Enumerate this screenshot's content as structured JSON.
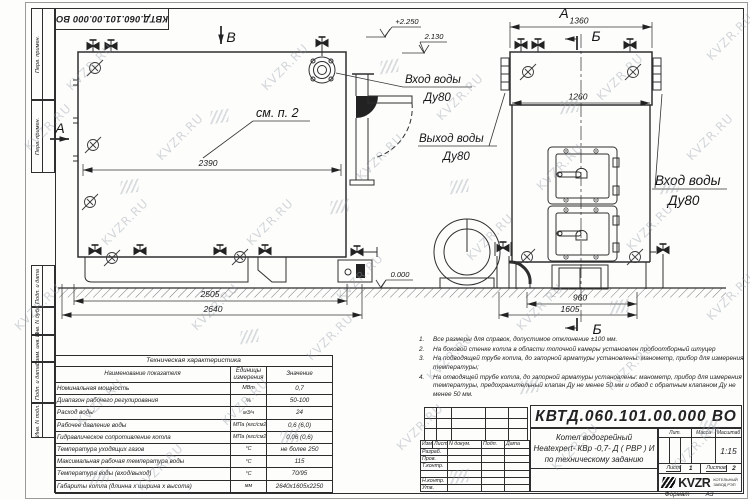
{
  "watermark": {
    "text": "KVZR.RU"
  },
  "margin": {
    "cells": [
      "Перв. примен.",
      "Перв. примен.",
      "Подп. и дата",
      "Инв. N дубл.",
      "Взам. инв. N",
      "Подп. и дата",
      "Инв. N подл."
    ]
  },
  "labels": {
    "view_b": "В",
    "view_a": "А",
    "section_b": "Б",
    "see_note": "см. п. 2",
    "water_in": "Вход воды",
    "water_out": "Выход воды",
    "dn": "Ду80",
    "elev_top": "+2.250",
    "elev_mid": "2.130",
    "elev_zero": "0.000"
  },
  "dims": {
    "side_inner": "2390",
    "side_base": "2505",
    "side_overall": "2640",
    "front_top": "1360",
    "front_inner": "1260",
    "front_base_inner": "960",
    "front_base": "1605"
  },
  "notes": [
    {
      "num": "1.",
      "text": "Все размеры для справок, допустимое отклонение ±100 мм."
    },
    {
      "num": "2.",
      "text": "На боковой стенке котла в области топочной камеры установлен пробоотборный штуцер"
    },
    {
      "num": "3.",
      "text": "На подводящей трубе котла, до запорной арматуры установлены: манометр, прибор для измерения температуры;"
    },
    {
      "num": "4.",
      "text": "На отводящей трубе котла, до запорной арматуры установлены: манометр, прибор для измерения температуры, предохранительный клапан Ду не менее 50 мм и обвод с обратным клапаном Ду не менее 50 мм."
    }
  ],
  "spec_table": {
    "title": "Техническая характеристика",
    "headers": [
      "Наименование показателя",
      "Единицы измерения",
      "Значение"
    ],
    "rows": [
      {
        "name": "Номинальная мощность",
        "unit": "МВт",
        "value": "0,7"
      },
      {
        "name": "Диапазон рабочего регулирования",
        "unit": "%",
        "value": "50-100"
      },
      {
        "name": "Расход воды",
        "unit": "м3/ч",
        "value": "24"
      },
      {
        "name": "Рабочее давление воды",
        "unit": "МПа (кгс/см2)",
        "value": "0,6 (6,0)"
      },
      {
        "name": "Гидравлическое сопротивление котла",
        "unit": "МПа (кгс/см2)",
        "value": "0,06 (0,6)"
      },
      {
        "name": "Температура уходящих газов",
        "unit": "°С",
        "value": "не более 250"
      },
      {
        "name": "Максимальная рабочая температура воды",
        "unit": "°С",
        "value": "115"
      },
      {
        "name": "Температура воды (вход/выход)",
        "unit": "°С",
        "value": "70/95"
      },
      {
        "name": "Габариты котла (длинна х ширина х высота)",
        "unit": "мм",
        "value": "2640х1605х2250"
      }
    ]
  },
  "title_block": {
    "doc_number": "КВТД.060.101.00.000 ВО",
    "header_cols": [
      "Изм.",
      "Лист",
      "N докум.",
      "Подп.",
      "Дата"
    ],
    "sign_rows": [
      "Разраб.",
      "Пров.",
      "Т.контр.",
      "",
      "Н.контр.",
      "Утв."
    ],
    "title_lines": [
      "Котел водогрейный",
      "Heatexpert- КВр -0,7- Д ( РВР ) И",
      "по техническому заданию"
    ],
    "lit_label": "Лит.",
    "mass_label": "Масса",
    "scale_label": "Масштаб",
    "scale_value": "1:15",
    "sheet_label": "Лист",
    "sheet_value": "1",
    "sheets_label": "Листов",
    "sheets_value": "2",
    "logo_text": "KVZR",
    "logo_sub1": "КОТЕЛЬНЫЙ",
    "logo_sub2": "ЗАВОД РЭП",
    "format_label": "Формат",
    "format_value": "А3"
  }
}
